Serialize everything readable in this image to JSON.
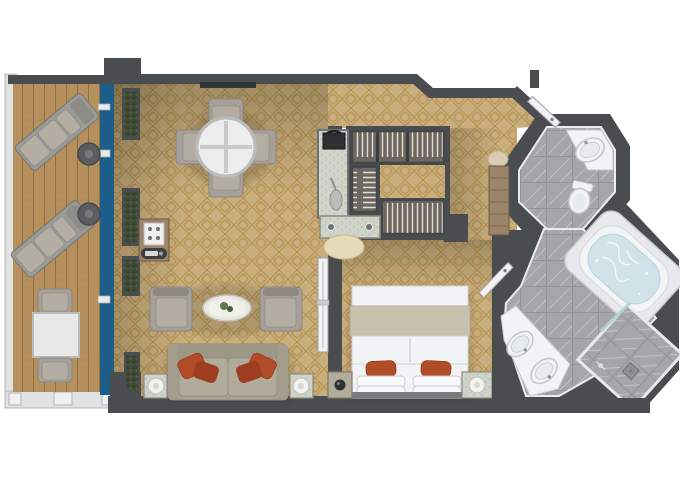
{
  "title": "Penthouse suite deck plan",
  "plan_type": "cruise-ship-suite-floor-plan",
  "colors": {
    "wall": "#494d50",
    "wallDark": "#3a3e41",
    "carpet": "#c9ae7d",
    "carpetLine": "#b0863d",
    "deck": "#b5905c",
    "deckLine": "#8d6f45",
    "glass": "#1d5d8a",
    "tile": "#a6a6a8",
    "tileLine": "#909092",
    "vein": "#d8d8da",
    "fixture": "#f1f3f4",
    "fixtureRim": "#c4c6c8",
    "water": "#cfe3e9",
    "sofa": "#a8a191",
    "cushion": "#b1ab9a",
    "accentPillow": "#b24b28",
    "chairGray": "#a5a09a",
    "tableWhite": "#eceded",
    "woodCab": "#9b8469",
    "marbleCounter": "#cfd4ca",
    "closetBg": "#6e6760",
    "hanger": "#e4dfd5",
    "plant": "#414b37",
    "bedWhite": "#f2f3f4",
    "bedThrow": "#c9c0ad",
    "stool": "#e6dcba",
    "railing": "#e0e2e3",
    "doorLeaf": "#f0f2f3",
    "metal": "#5a5e61"
  },
  "rooms": [
    {
      "id": "balcony",
      "name": "Veranda balcony",
      "floor": "teak deck",
      "furniture": [
        "sun-lounger",
        "sun-lounger",
        "round-side-table",
        "round-side-table",
        "square-table",
        "deck-chair",
        "deck-chair"
      ]
    },
    {
      "id": "living",
      "name": "Living / dining room",
      "floor": "patterned carpet",
      "furniture": [
        "dining-table-round",
        "dining-chair x4",
        "bar-cabinet",
        "armchair x2",
        "oval-coffee-table",
        "sofa",
        "accent-pillows x4",
        "lamp-side-table x2",
        "planters x4",
        "wall-tv"
      ]
    },
    {
      "id": "closet",
      "name": "Walk-in wardrobe",
      "furniture": [
        "hanging-rail x3",
        "marble-pantry-counter",
        "safe",
        "dressing-table",
        "stool"
      ]
    },
    {
      "id": "bedroom",
      "name": "Bedroom",
      "furniture": [
        "queen-bed",
        "nightstand x2",
        "sliding-door"
      ]
    },
    {
      "id": "wc",
      "name": "Guest WC",
      "furniture": [
        "corner-washbasin",
        "toilet"
      ]
    },
    {
      "id": "bathroom",
      "name": "Master bathroom",
      "furniture": [
        "double-vanity",
        "whirlpool-tub",
        "shower-enclosure",
        "glass-door",
        "hall-cabinet"
      ]
    }
  ]
}
